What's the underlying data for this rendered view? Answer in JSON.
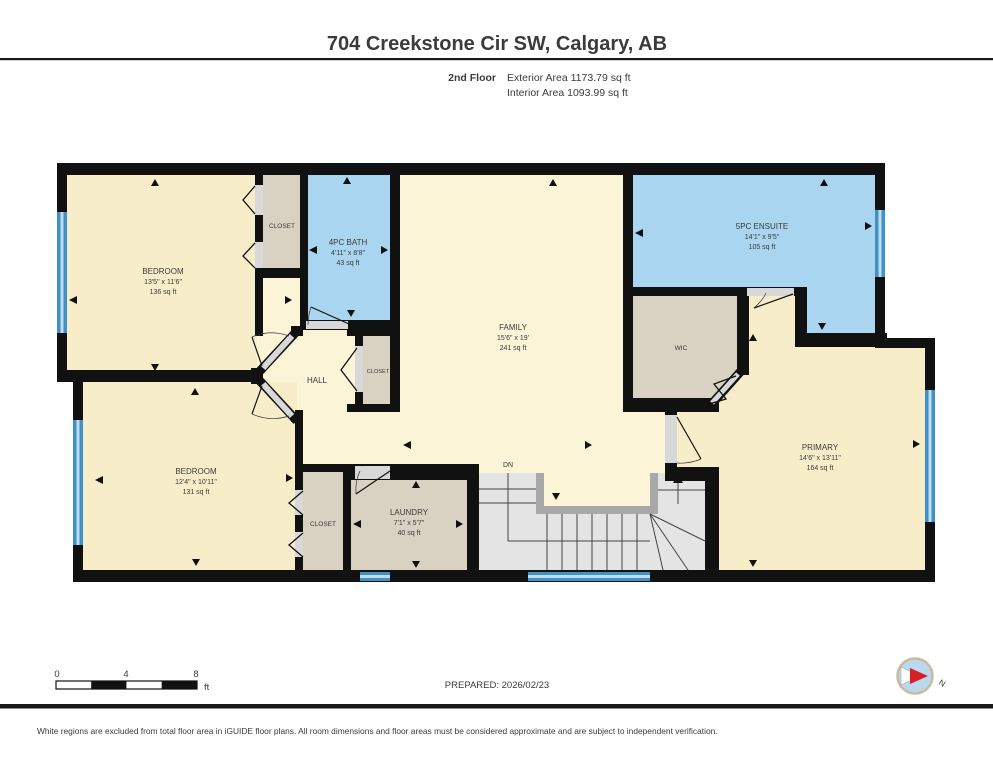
{
  "header": {
    "title": "704 Creekstone Cir SW, Calgary, AB",
    "floor": "2nd Floor",
    "exterior": "Exterior Area 1173.79 sq ft",
    "interior": "Interior Area 1093.99 sq ft"
  },
  "rooms": {
    "bedroom1": {
      "name": "BEDROOM",
      "dims": "13'5\" x 11'6\"",
      "area": "136 sq ft"
    },
    "closet1": {
      "name": "CLOSET"
    },
    "bath": {
      "name": "4PC BATH",
      "dims": "4'11\" x 8'8\"",
      "area": "43 sq ft"
    },
    "family": {
      "name": "FAMILY",
      "dims": "15'6\" x 19'",
      "area": "241 sq ft"
    },
    "ensuite": {
      "name": "5PC ENSUITE",
      "dims": "14'1\" x 9'5\"",
      "area": "105 sq ft"
    },
    "wic": {
      "name": "WIC"
    },
    "hall": {
      "name": "HALL"
    },
    "hall_closet": {
      "name": "CLOSET"
    },
    "primary": {
      "name": "PRIMARY",
      "dims": "14'6\" x 13'11\"",
      "area": "164 sq ft"
    },
    "bedroom2": {
      "name": "BEDROOM",
      "dims": "12'4\" x 10'11\"",
      "area": "131 sq ft"
    },
    "closet2": {
      "name": "CLOSET"
    },
    "laundry": {
      "name": "LAUNDRY",
      "dims": "7'1\" x 5'7\"",
      "area": "40 sq ft"
    },
    "stairs": {
      "label": "DN"
    }
  },
  "scalebar": {
    "t0": "0",
    "t4": "4",
    "t8": "8",
    "unit": "ft"
  },
  "prepared": "PREPARED: 2026/02/23",
  "compass": {
    "north": "N"
  },
  "footer": "White regions are excluded from total floor area in iGUIDE floor plans. All room dimensions and floor areas must be considered approximate and are subject to independent verification.",
  "colors": {
    "room_cream": "#f8edc9",
    "hall_cream": "#fcf4d7",
    "wet_blue": "#a9d5f0",
    "closet_tan": "#d9d1c2",
    "stair_gray": "#e4e4e4",
    "railing_gray": "#a8a8a8",
    "window_blue": "#4191c5",
    "wall_black": "#111111"
  }
}
